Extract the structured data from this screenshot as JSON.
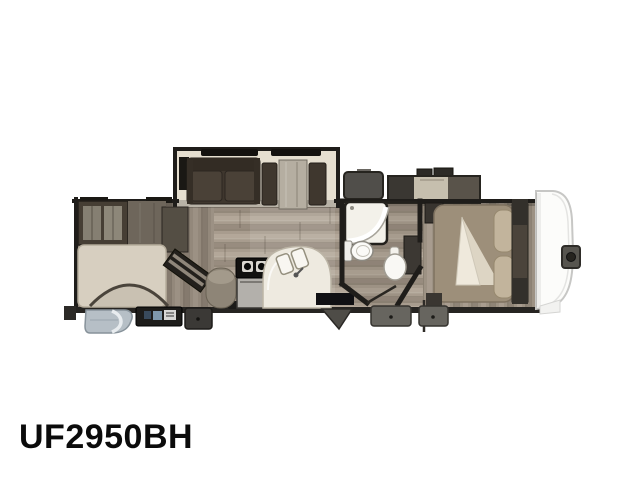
{
  "label": {
    "model": "UF2950BH"
  },
  "floorplan": {
    "view": "top-down-rv-floorplan",
    "features": [
      "rear-bunkhouse",
      "glass-front-cabinet",
      "bunk-bed",
      "entry-door-arc",
      "angled-entertainment-unit",
      "kitchen-round-counter",
      "stove-oven",
      "curved-double-sink-counter",
      "sofa-slide-out",
      "booth-dinette",
      "bathroom-shower",
      "toilet",
      "pedestal-sink",
      "bedroom-queen-bed",
      "folded-blanket",
      "wardrobe-slide",
      "front-cap",
      "hitch-pin",
      "entry-steps",
      "utility-boxes"
    ]
  },
  "colors": {
    "background": "#ffffff",
    "outline": "#1f1d1a",
    "floor_light": "#a89c8e",
    "floor_dark": "#857a6e",
    "slide_trim": "#e6dfd0",
    "sofa": "#3f372e",
    "bunk_bed": "#d7cfc0",
    "bedroom_bed": "#9d8f7a",
    "counter_white": "#eeeae0",
    "entry_step": "#b6bfc6",
    "front_cap": "#fcfcfa"
  }
}
